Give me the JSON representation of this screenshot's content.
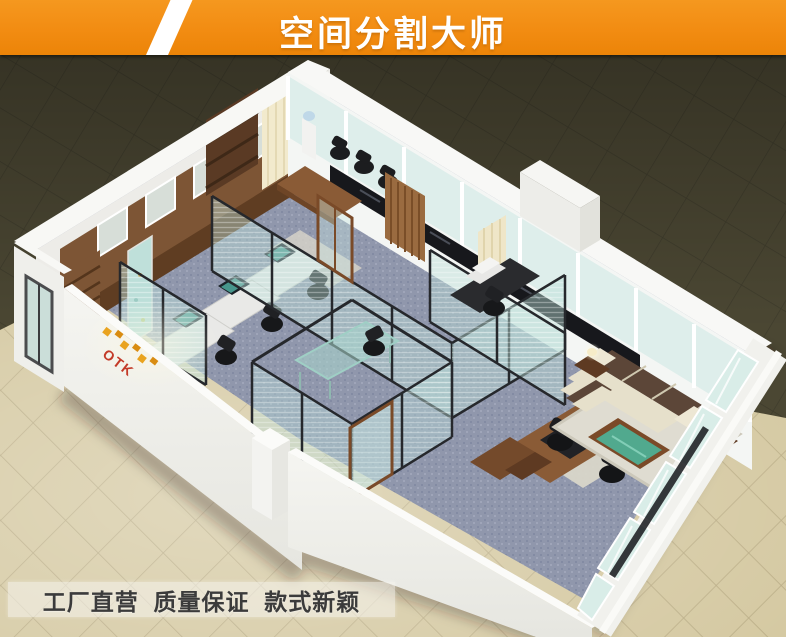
{
  "banner": {
    "title": "空间分割大师",
    "bg_color": "#F28C12",
    "text_color": "#FFFFFF"
  },
  "scene": {
    "logo_text": "OTK",
    "logo_color": "#C33A28",
    "description": "Isometric 3D render of an open-plan office divided by black-framed glass partition walls: reception with wood table, staff cubicles with monitors, glass manager office, executive desk room and a sofa lounge"
  },
  "footer": {
    "slogan": "工厂直营  质量保证  款式新颖",
    "text_color": "#3B3B3B"
  },
  "colors": {
    "banner_orange": "#F28C12",
    "outside_floor_dark": "#4B4733",
    "outside_floor_beige": "#D5C9A2",
    "wall_white": "#F2F2EE",
    "carpet_blue_gray": "#9097AC",
    "glass_aqua": "#CFE7E2",
    "partition_frame": "#26282C",
    "wood_brown": "#8A5B36",
    "sofa_cream": "#E6E0CB",
    "sofa_dark_brown": "#5C4638",
    "coffee_table_glass_green": "#4FAE94"
  }
}
